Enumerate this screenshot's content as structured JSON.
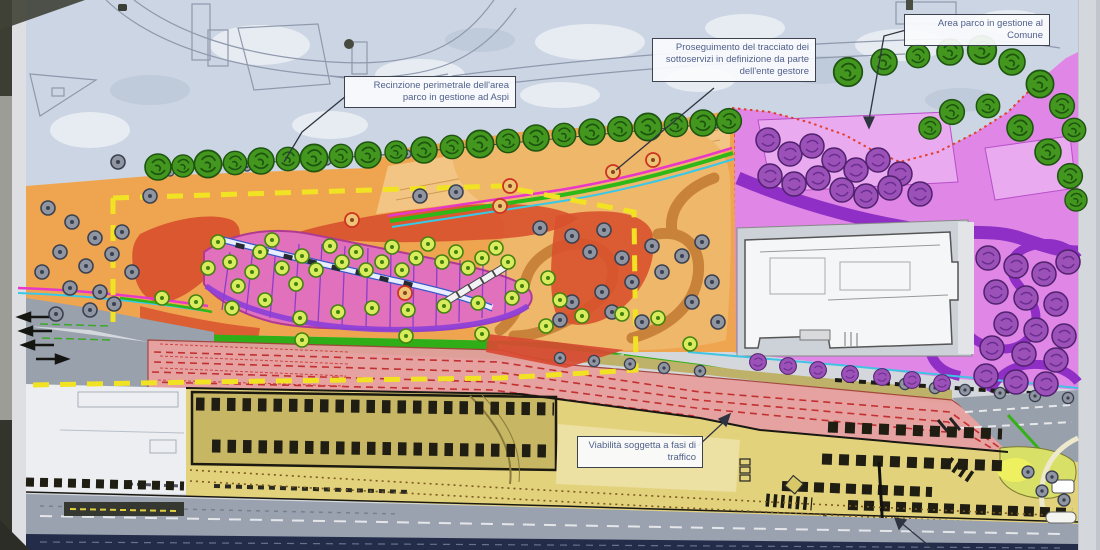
{
  "plan": {
    "annotations": {
      "recinzione": "Recinzione perimetrale dell'area parco in gestione ad Aspi",
      "proseguimento": "Proseguimento del tracciato dei sottoservizi in definizione da parte dell'ente gestore",
      "area_parco": "Area parco in gestione al Comune",
      "viabilita": "Viabilità soggetta a fasi di traffico"
    },
    "colors": {
      "park_aspi": "#efa54f",
      "park_comune": "#df86e6",
      "perimeter_fence": "#f2e224",
      "traffic_zone": "#e79f9e",
      "green_strip": "#2fae17",
      "bottom_road": "#232d4a"
    }
  }
}
